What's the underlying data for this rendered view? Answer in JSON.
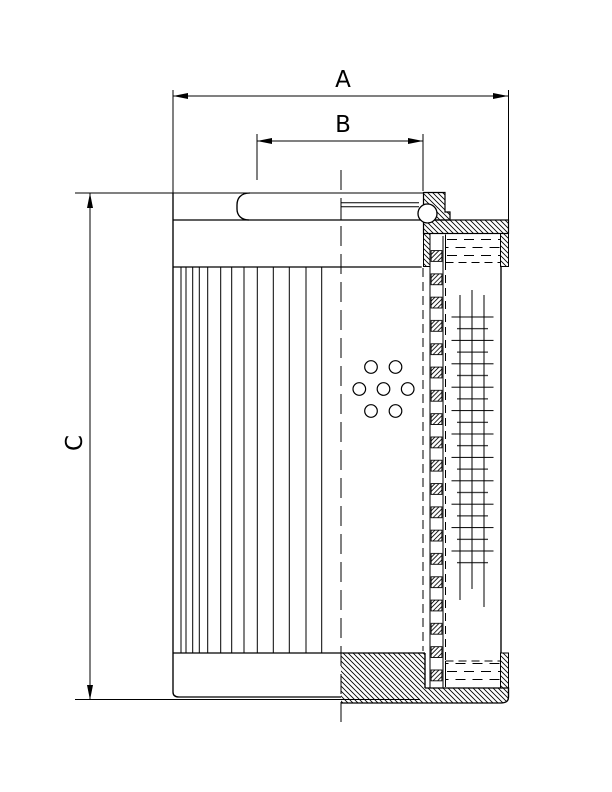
{
  "drawing": {
    "labels": {
      "dim_a": "A",
      "dim_b": "B",
      "dim_c": "C"
    },
    "colors": {
      "line": "#000000",
      "background": "#ffffff"
    }
  }
}
